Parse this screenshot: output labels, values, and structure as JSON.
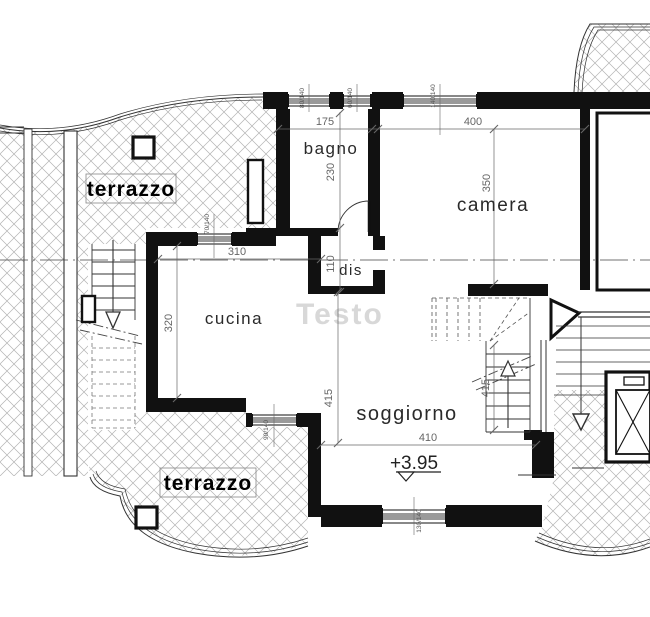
{
  "watermark": "Testo",
  "rooms": {
    "terrazzo_top": "terrazzo",
    "terrazzo_bottom": "terrazzo",
    "bagno": "bagno",
    "camera": "camera",
    "dis": "dis",
    "cucina": "cucina",
    "soggiorno": "soggiorno"
  },
  "dimensions": {
    "bagno_width": "175",
    "camera_width": "400",
    "bagno_height": "230",
    "camera_height": "350",
    "dis_height": "110",
    "cucina_width": "310",
    "cucina_height": "320",
    "soggiorno_height": "415",
    "soggiorno_width": "410",
    "stair_run": "415"
  },
  "window_sizes": {
    "bagno": "80/140",
    "corridor": "60/140",
    "camera": "140/140",
    "cucina_top": "70/140",
    "cucina_bottom": "90/140",
    "soggiorno": "130/140"
  },
  "level_marker": "+3.95",
  "colors": {
    "wall": "#111111",
    "hatch": "#b3b3b3",
    "dimension": "#666666",
    "window_fill": "#9a9a9a",
    "watermark": "#d4d4d4"
  }
}
